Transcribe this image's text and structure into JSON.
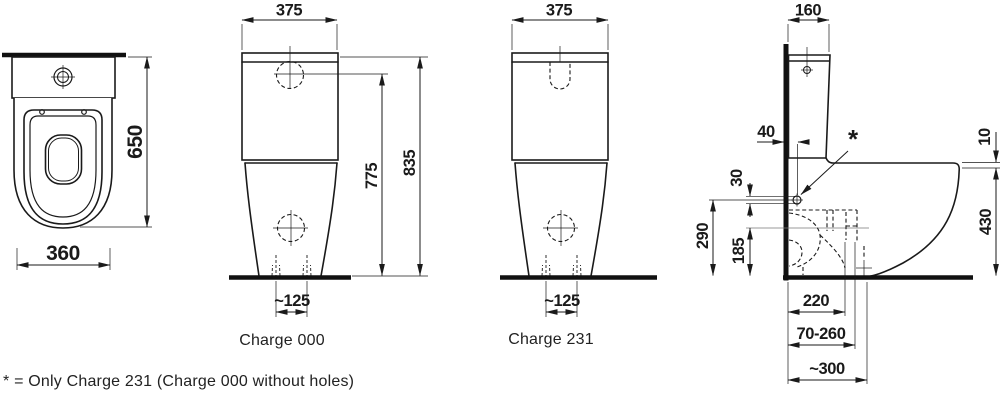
{
  "footnote": "* = Only Charge 231 (Charge 000 without holes)",
  "labels": {
    "charge000": "Charge 000",
    "charge231": "Charge 231"
  },
  "dims": {
    "top_height": "650",
    "top_width": "360",
    "front000_width": "375",
    "front000_button_height": "775",
    "front000_total_height": "835",
    "front000_bolt_spacing": "~125",
    "front231_width": "375",
    "front231_bolt_spacing": "~125",
    "side_cistern_depth": "160",
    "side_hole_offset": "40",
    "side_hole_diameter": "30",
    "side_hole_height": "290",
    "side_trap_height": "185",
    "side_seat_gap": "10",
    "side_rim_height": "430",
    "side_outlet_distance": "220",
    "side_outlet_range": "70-260",
    "side_depth_at_floor": "~300",
    "side_note_mark": "*"
  }
}
